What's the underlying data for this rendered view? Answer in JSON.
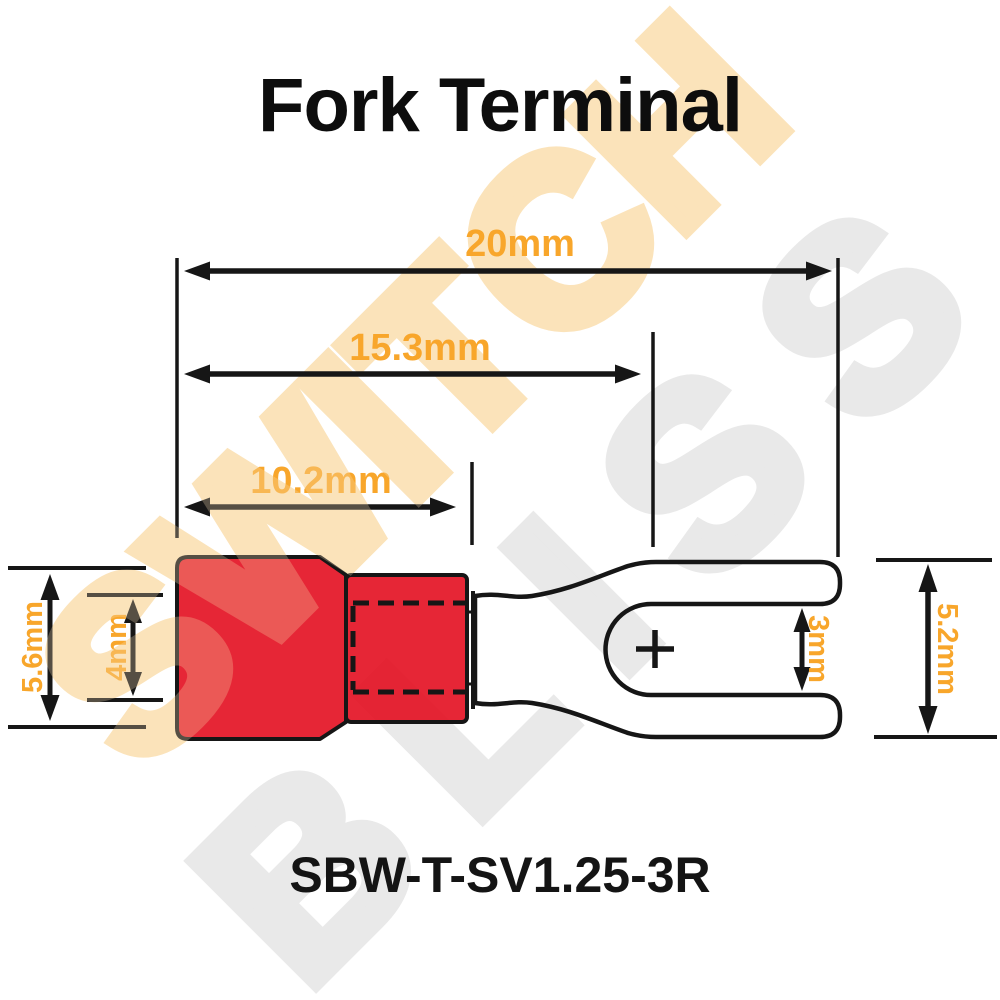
{
  "title": "Fork Terminal",
  "part_number": "SBW-T-SV1.25-3R",
  "watermark": {
    "line1": "SWITCH",
    "line2": "BLISS"
  },
  "colors": {
    "accent_orange": "#F8A62B",
    "terminal_red": "#E30E20",
    "line_black": "#161616",
    "watermark_peach": "#FBE3BA",
    "watermark_gray": "#E9E9E9"
  },
  "dimensions": {
    "total_length": {
      "label": "20mm"
    },
    "to_fork_notch": {
      "label": "15.3mm"
    },
    "insulation_length": {
      "label": "10.2mm"
    },
    "insulation_od": {
      "label": "5.6mm"
    },
    "wire_entry_id": {
      "label": "4mm"
    },
    "fork_gap": {
      "label": "3mm"
    },
    "fork_width": {
      "label": "5.2mm"
    }
  }
}
